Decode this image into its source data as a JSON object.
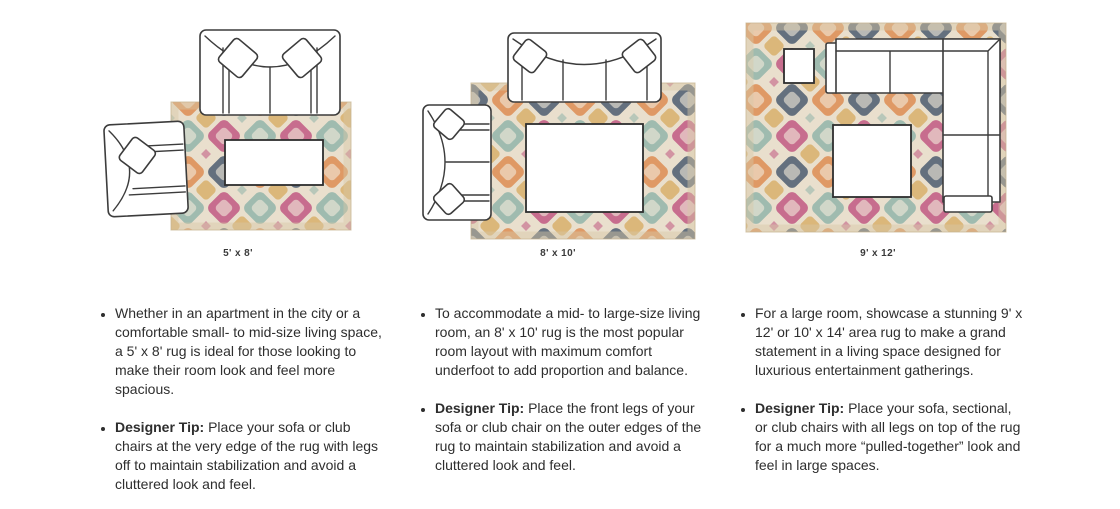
{
  "colors": {
    "rug_base": "#e9dfcd",
    "rug_orange": "#dd8a4e",
    "rug_navy": "#46586d",
    "rug_pink": "#c05480",
    "rug_teal": "#8fb3a9",
    "rug_gold": "#d7a95f",
    "rug_inner": "#f2e9da",
    "line_art": "#3c3c3c",
    "text": "#2e2e2e"
  },
  "columns": [
    {
      "caption": "5' x 8'",
      "diagram": "sofa-and-club-chair-with-legs-off-rug",
      "bullet1": "Whether in an apartment in the city or a comfortable small- to mid-size living space, a 5' x 8' rug is ideal for those looking to make their room look and feel more spacious.",
      "tip_label": "Designer Tip:",
      "tip_text": " Place your sofa or club chairs at the very edge of the rug with legs off to maintain stabilization and avoid a cluttered look and feel."
    },
    {
      "caption": "8' x 10'",
      "diagram": "sofa-and-loveseat-front-legs-on-rug",
      "bullet1": "To accommodate a mid- to large-size living room, an 8' x 10' rug is the most popular room layout with maximum comfort underfoot to add proportion and balance.",
      "tip_label": "Designer Tip:",
      "tip_text": " Place the front legs of your sofa or club chair on the outer edges of the rug to maintain stabilization and avoid a cluttered look and feel."
    },
    {
      "caption": "9' x 12'",
      "diagram": "sectional-with-all-legs-on-rug",
      "bullet1": "For a large room, showcase a stunning 9' x 12' or 10' x 14' area rug to make a grand statement in a living space designed for luxurious entertainment gatherings.",
      "tip_label": "Designer Tip:",
      "tip_text": " Place your sofa, sectional, or club chairs with all legs on top of the rug for a much more “pulled-together” look and feel in large spaces."
    }
  ]
}
